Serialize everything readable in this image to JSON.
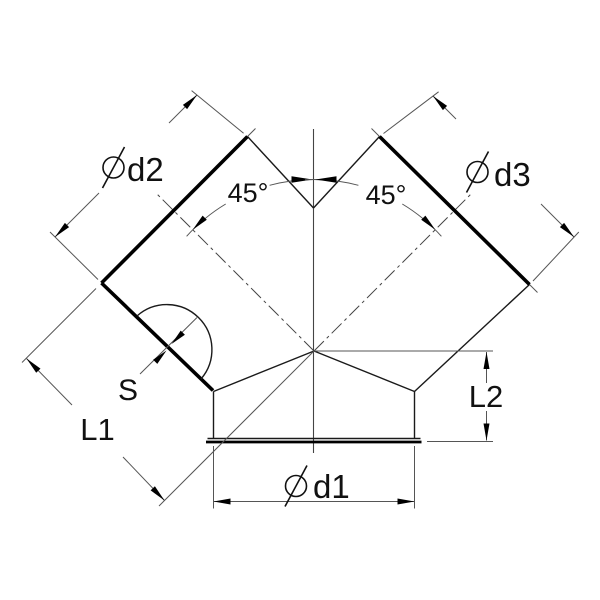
{
  "drawing": {
    "labels": {
      "diameter_symbol": "⌀",
      "branch_left_diameter": "d2",
      "branch_right_diameter": "d3",
      "bottom_diameter": "d1",
      "angle_left": "45°",
      "angle_right": "45°",
      "thickness": "S",
      "branch_length": "L1",
      "collar_height": "L2"
    },
    "colors": {
      "line": "#000000",
      "dimension_line": "#555555",
      "background": "#ffffff"
    }
  }
}
